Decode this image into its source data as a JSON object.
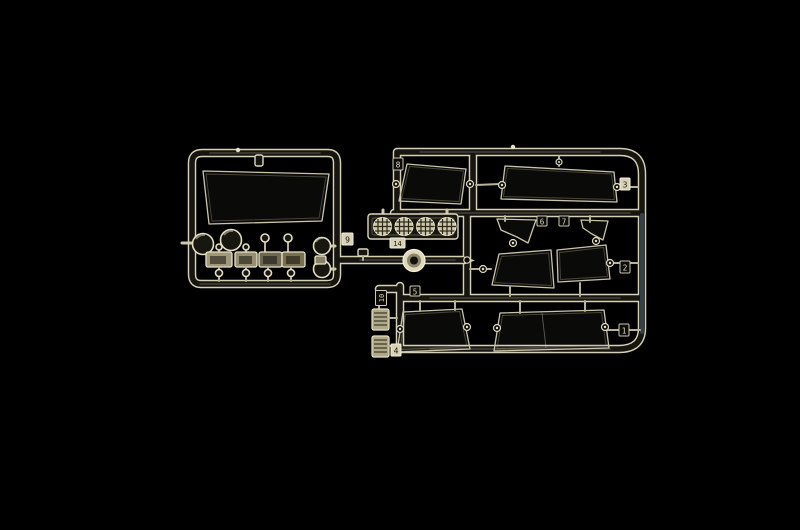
{
  "photo": {
    "description": "Studio photo of a clear transparent plastic model-kit sprue (glazing parts tree for a truck model) on a black background",
    "background_color": "#000000"
  },
  "colors": {
    "plastic_edge": "#d8d3b8",
    "plastic_bright": "#f0ebd2",
    "plastic_dark": "#14130e",
    "spotlight_lens_fill": "#cfc8a6",
    "blue_reflection": "#8aa8d8"
  },
  "sprue": {
    "material": "clear plastic",
    "tags": [
      {
        "number": "9"
      },
      {
        "number": "14"
      },
      {
        "number": "8"
      },
      {
        "number": "6"
      },
      {
        "number": "7"
      },
      {
        "number": "3"
      },
      {
        "number": "2"
      },
      {
        "number": "1"
      },
      {
        "number": "10"
      },
      {
        "number": "5"
      },
      {
        "number": "4"
      }
    ],
    "parts": [
      "windshield pane",
      "rear window pane",
      "large side window pane",
      "two vent quarter-windows",
      "two door window panes",
      "two lower window panes",
      "four round headlight lenses",
      "four rectangular lamp lenses",
      "roof spotlight bar with four cross-hatched lenses",
      "beacon ring on center runner",
      "two ribbed indicator lenses"
    ]
  }
}
